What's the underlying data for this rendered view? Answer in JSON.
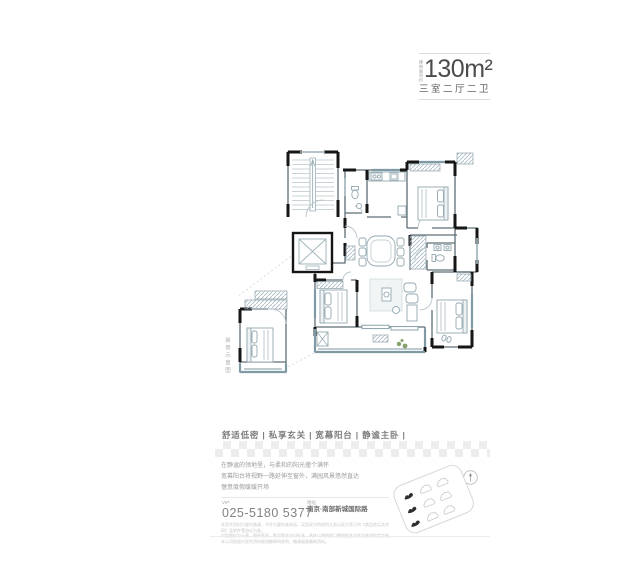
{
  "header": {
    "area_prefix": "建筑面积约",
    "area": "130m²",
    "rooms": "三室二厅二卫"
  },
  "floor_plan": {
    "detail_label": "装修示意图"
  },
  "tagline": "舒适低密 | 私享玄关 | 宽幕阳台 | 静谧主卧 |",
  "description": {
    "line1": "在静谧的领地里，与柔和的阳光撞个满怀",
    "line2": "宽幕阳台将视野一路延伸至窗外，满园风景悠然直达",
    "line3": "惬意度假缓缓开场"
  },
  "contact": {
    "vip_label": "VIP:",
    "phone": "025-5180 5377",
    "address_label": "地址:",
    "address": "南京·南部新城国际路"
  },
  "disclaimer": {
    "line1": "本宣传资料为要约邀请，不作为要约或承诺，买卖双方的权利义务以双方签订的《商品房买卖合同》及附件等协议为准。",
    "line2": "户型图仅为示意，图中家具、陈设等非交付标准，具体以政府部门最终批准文件及合同约定为准。",
    "line3": "本公司保留对宣传资料修改解释的权利，敬请留意最新资料。"
  },
  "colors": {
    "wall": "#1f1f1f",
    "glass_teal": "#7f9aa5",
    "checker_gray": "#ededed",
    "plant_green": "#86a06a",
    "text_gray": "#8a8a8a"
  }
}
